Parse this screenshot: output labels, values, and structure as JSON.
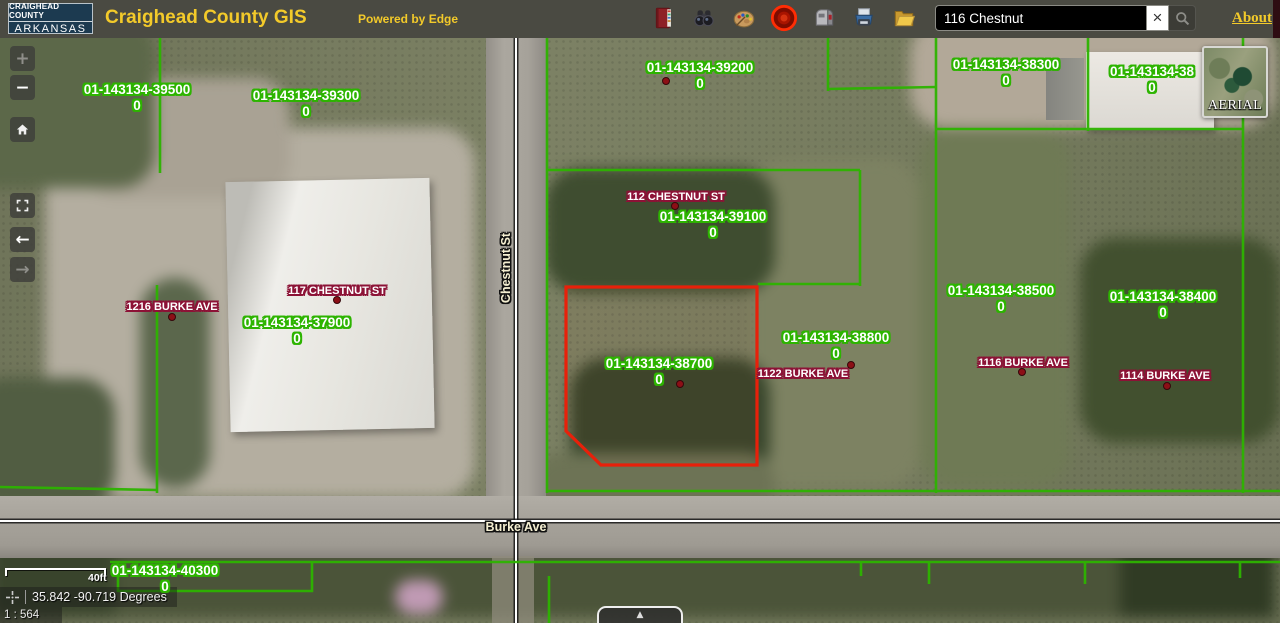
{
  "header": {
    "logo_line1": "CRAIGHEAD COUNTY",
    "logo_line2": "ARKANSAS",
    "title": "Craighead County GIS",
    "powered_by": "Powered by Edge",
    "search_value": "116 Chestnut",
    "clear_glyph": "×",
    "about": "About",
    "bg_color": "#4a4a42",
    "accent_color": "#f3ca2a"
  },
  "toolbar_icons": [
    "red-book-icon",
    "binoculars-icon",
    "palette-icon",
    "target-icon",
    "mailbox-icon",
    "printer-icon",
    "folder-icon"
  ],
  "map_controls": {
    "zoom_in": "+",
    "zoom_out": "−",
    "back_arrow": "←",
    "forward_arrow": "→"
  },
  "basemap": {
    "label": "AERIAL"
  },
  "map": {
    "colors": {
      "parcel_halo": "#2db400",
      "address_halo": "#8c1236",
      "selected_parcel": "#e8200a"
    },
    "parcel_labels": [
      {
        "id": "01-143134-39500",
        "sub": "0",
        "x": 137,
        "y": 82
      },
      {
        "id": "01-143134-39300",
        "sub": "0",
        "x": 306,
        "y": 88
      },
      {
        "id": "01-143134-39200",
        "sub": "0",
        "x": 700,
        "y": 60
      },
      {
        "id": "01-143134-38300",
        "sub": "0",
        "x": 1006,
        "y": 57
      },
      {
        "id": "01-143134-38",
        "sub": "0",
        "x": 1152,
        "y": 64
      },
      {
        "id": "01-143134-39100",
        "sub": "0",
        "x": 713,
        "y": 209
      },
      {
        "id": "01-143134-37900",
        "sub": "0",
        "x": 297,
        "y": 315
      },
      {
        "id": "01-143134-38700",
        "sub": "0",
        "x": 659,
        "y": 356
      },
      {
        "id": "01-143134-38800",
        "sub": "0",
        "x": 836,
        "y": 330
      },
      {
        "id": "01-143134-38500",
        "sub": "0",
        "x": 1001,
        "y": 283
      },
      {
        "id": "01-143134-38400",
        "sub": "0",
        "x": 1163,
        "y": 289
      },
      {
        "id": "01-143134-40300",
        "sub": "0",
        "x": 165,
        "y": 563
      }
    ],
    "address_labels": [
      {
        "text": "112 CHESTNUT ST",
        "x": 676,
        "y": 191
      },
      {
        "text": "117 CHESTNUT ST",
        "x": 337,
        "y": 285
      },
      {
        "text": "1216 BURKE AVE",
        "x": 172,
        "y": 301
      },
      {
        "text": "1122 BURKE AVE",
        "x": 803,
        "y": 368
      },
      {
        "text": "1116 BURKE AVE",
        "x": 1023,
        "y": 357
      },
      {
        "text": "1114 BURKE AVE",
        "x": 1165,
        "y": 370
      }
    ],
    "street_labels": [
      {
        "text": "Chestnut St",
        "x": 506,
        "y": 268,
        "rotate": -90
      },
      {
        "text": "Burke Ave",
        "x": 516,
        "y": 527,
        "rotate": 0
      }
    ],
    "dots": [
      [
        666,
        81
      ],
      [
        675,
        206
      ],
      [
        337,
        300
      ],
      [
        172,
        317
      ],
      [
        680,
        384
      ],
      [
        851,
        365
      ],
      [
        1022,
        372
      ],
      [
        1167,
        386
      ]
    ]
  },
  "statusbar": {
    "scalebar_max": "40ft",
    "coordinates": "35.842 -90.719 Degrees",
    "scale_ratio": "1 : 564"
  },
  "expander_glyph": "▲"
}
